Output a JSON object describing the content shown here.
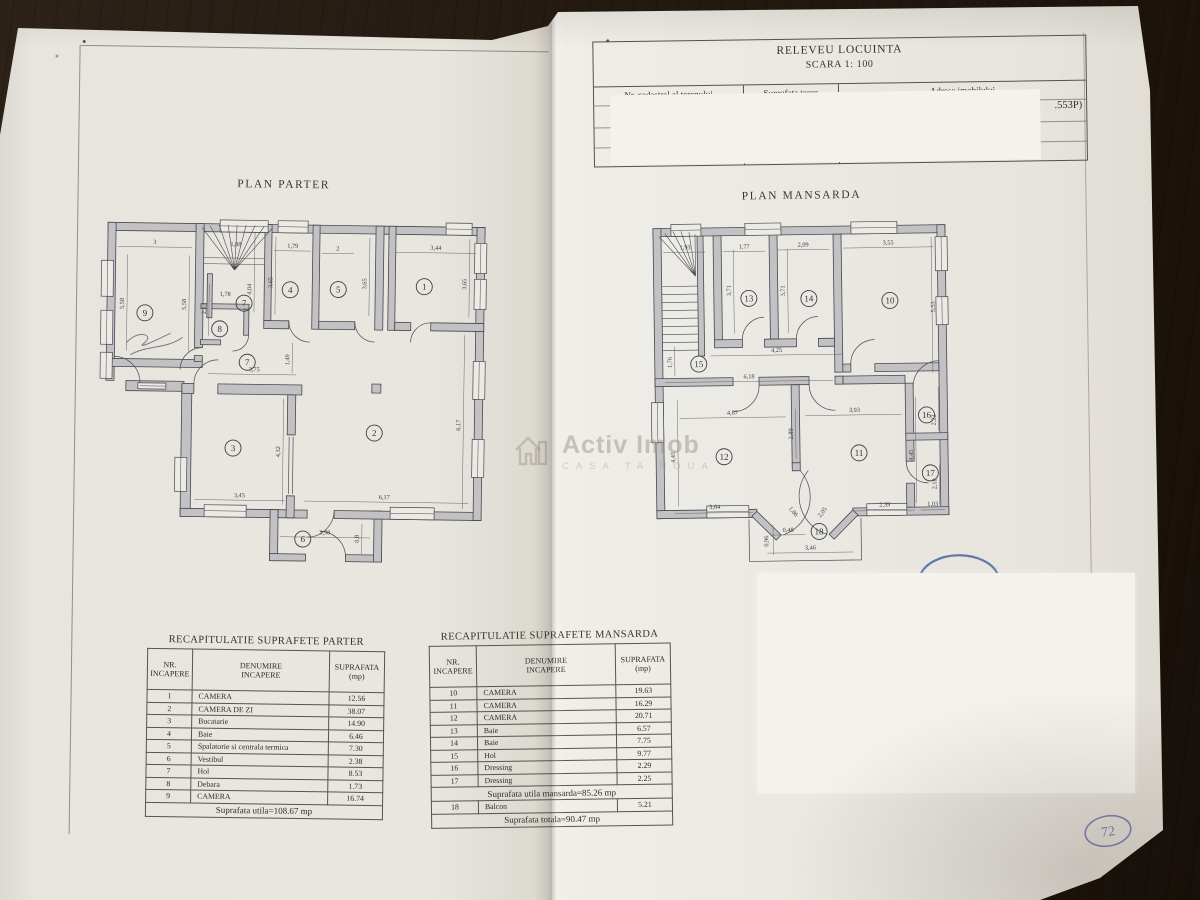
{
  "header": {
    "title": "RELEVEU LOCUINTA",
    "scale": "SCARA 1: 100",
    "columns": [
      "Nr. cadastral al terenului",
      "Suprafata teren",
      "Adresa imobilului"
    ],
    "fragment": ".553P)"
  },
  "watermark": {
    "brand": "Activ Imob",
    "tagline": "CASA TA NOUA"
  },
  "page_note": "72",
  "plans": [
    {
      "id": "parter",
      "title": "PLAN PARTER",
      "rooms": [
        {
          "n": "1",
          "x": 327,
          "y": 72
        },
        {
          "n": "2",
          "x": 279,
          "y": 219
        },
        {
          "n": "3",
          "x": 138,
          "y": 236
        },
        {
          "n": "4",
          "x": 193,
          "y": 77
        },
        {
          "n": "5",
          "x": 241,
          "y": 76
        },
        {
          "n": "6",
          "x": 209,
          "y": 326
        },
        {
          "n": "7",
          "x": 147,
          "y": 91
        },
        {
          "n": "7",
          "x": 151,
          "y": 150
        },
        {
          "n": "8",
          "x": 123,
          "y": 117
        },
        {
          "n": "9",
          "x": 48,
          "y": 102
        }
      ],
      "dims": [
        {
          "t": "3",
          "x": 57,
          "y": 33,
          "r": 0
        },
        {
          "t": "1,88",
          "x": 138,
          "y": 34,
          "r": 0
        },
        {
          "t": "1,79",
          "x": 195,
          "y": 35,
          "r": 0
        },
        {
          "t": "2",
          "x": 240,
          "y": 37,
          "r": 0
        },
        {
          "t": "3,44",
          "x": 338,
          "y": 35,
          "r": 0
        },
        {
          "t": "5,58",
          "x": 27,
          "y": 93,
          "r": -90
        },
        {
          "t": "5,58",
          "x": 89,
          "y": 93,
          "r": -90
        },
        {
          "t": "2,23",
          "x": 109,
          "y": 97,
          "r": -90
        },
        {
          "t": "1,78",
          "x": 128,
          "y": 84,
          "r": 0
        },
        {
          "t": "4,04",
          "x": 154,
          "y": 77,
          "r": -90
        },
        {
          "t": "3,65",
          "x": 175,
          "y": 70,
          "r": -90
        },
        {
          "t": "3,65",
          "x": 269,
          "y": 70,
          "r": -90
        },
        {
          "t": "3,65",
          "x": 369,
          "y": 69,
          "r": -90
        },
        {
          "t": "3,75",
          "x": 158,
          "y": 159,
          "r": 0
        },
        {
          "t": "1,49",
          "x": 193,
          "y": 147,
          "r": -90
        },
        {
          "t": "4,32",
          "x": 185,
          "y": 239,
          "r": -90
        },
        {
          "t": "3,45",
          "x": 145,
          "y": 285,
          "r": 0
        },
        {
          "t": "6,17",
          "x": 290,
          "y": 285,
          "r": 0
        },
        {
          "t": "6,17",
          "x": 365,
          "y": 210,
          "r": -90
        },
        {
          "t": "2,98",
          "x": 231,
          "y": 321,
          "r": 0
        },
        {
          "t": "0,8",
          "x": 265,
          "y": 325,
          "r": -90
        }
      ]
    },
    {
      "id": "mansarda",
      "title": "PLAN MANSARDA",
      "rooms": [
        {
          "n": "10",
          "x": 244,
          "y": 85
        },
        {
          "n": "11",
          "x": 211,
          "y": 237
        },
        {
          "n": "12",
          "x": 76,
          "y": 239
        },
        {
          "n": "13",
          "x": 103,
          "y": 81
        },
        {
          "n": "14",
          "x": 163,
          "y": 82
        },
        {
          "n": "15",
          "x": 52,
          "y": 146
        },
        {
          "n": "16",
          "x": 279,
          "y": 200
        },
        {
          "n": "17",
          "x": 282,
          "y": 258
        },
        {
          "n": "18",
          "x": 170,
          "y": 315
        }
      ],
      "dims": [
        {
          "t": "1,93",
          "x": 40,
          "y": 31,
          "r": 0
        },
        {
          "t": "1,77",
          "x": 99,
          "y": 31,
          "r": 0
        },
        {
          "t": "2,09",
          "x": 158,
          "y": 30,
          "r": 0
        },
        {
          "t": "3,55",
          "x": 243,
          "y": 29,
          "r": 0
        },
        {
          "t": "3,71",
          "x": 85,
          "y": 73,
          "r": -90
        },
        {
          "t": "3,71",
          "x": 139,
          "y": 74,
          "r": -90
        },
        {
          "t": "5,53",
          "x": 289,
          "y": 92,
          "r": -90
        },
        {
          "t": "4,25",
          "x": 130,
          "y": 135,
          "r": 0
        },
        {
          "t": "1,76",
          "x": 25,
          "y": 144,
          "r": -90
        },
        {
          "t": "6,18",
          "x": 102,
          "y": 161,
          "r": 0
        },
        {
          "t": "4,87",
          "x": 85,
          "y": 197,
          "r": 0
        },
        {
          "t": "3,93",
          "x": 207,
          "y": 196,
          "r": 0
        },
        {
          "t": "2,89",
          "x": 145,
          "y": 217,
          "r": -90
        },
        {
          "t": "4,45",
          "x": 27,
          "y": 239,
          "r": -90
        },
        {
          "t": "4,45",
          "x": 265,
          "y": 240,
          "r": -90
        },
        {
          "t": "2,22",
          "x": 288,
          "y": 205,
          "r": -90
        },
        {
          "t": "2,18",
          "x": 288,
          "y": 269,
          "r": -90
        },
        {
          "t": "3,64",
          "x": 66,
          "y": 291,
          "r": 0
        },
        {
          "t": "2,39",
          "x": 236,
          "y": 291,
          "r": 0
        },
        {
          "t": "1,03",
          "x": 284,
          "y": 291,
          "r": 0
        },
        {
          "t": "1,86",
          "x": 143,
          "y": 296,
          "r": 52
        },
        {
          "t": "2,05",
          "x": 175,
          "y": 297,
          "r": -52
        },
        {
          "t": "0,48",
          "x": 139,
          "y": 315,
          "r": 0
        },
        {
          "t": "0,96",
          "x": 119,
          "y": 324,
          "r": -90
        },
        {
          "t": "3,46",
          "x": 161,
          "y": 333,
          "r": 0
        }
      ]
    }
  ],
  "tables": [
    {
      "title": "RECAPITULATIE SUPRAFETE PARTER",
      "headers": {
        "nr": "NR.\nINCAPERE",
        "den": "DENUMIRE\nINCAPERE",
        "sup": "SUPRAFATA\n(mp)"
      },
      "rows": [
        [
          "1",
          "CAMERA",
          "12.56"
        ],
        [
          "2",
          "CAMERA DE ZI",
          "38.07"
        ],
        [
          "3",
          "Bucatarie",
          "14.90"
        ],
        [
          "4",
          "Baie",
          "6.46"
        ],
        [
          "5",
          "Spalatorie si centrala termica",
          "7.30"
        ],
        [
          "6",
          "Vestibul",
          "2.38"
        ],
        [
          "7",
          "Hol",
          "8.53"
        ],
        [
          "8",
          "Debara",
          "1.73"
        ],
        [
          "9",
          "CAMERA",
          "16.74"
        ]
      ],
      "total": "Suprafata utila=108.67 mp"
    },
    {
      "title": "RECAPITULATIE SUPRAFETE MANSARDA",
      "headers": {
        "nr": "NR.\nINCAPERE",
        "den": "DENUMIRE\nINCAPERE",
        "sup": "SUPRAFATA\n(mp)"
      },
      "rows": [
        [
          "10",
          "CAMERA",
          "19.63"
        ],
        [
          "11",
          "CAMERA",
          "16.29"
        ],
        [
          "12",
          "CAMERA",
          "20.71"
        ],
        [
          "13",
          "Baie",
          "6.57"
        ],
        [
          "14",
          "Baie",
          "7.75"
        ],
        [
          "15",
          "Hol",
          "9.77"
        ],
        [
          "16",
          "Dressing",
          "2.29"
        ],
        [
          "17",
          "Dressing",
          "2.25"
        ]
      ],
      "subtotal": "Suprafata utila mansarda=85.26 mp",
      "extra_row": [
        "18",
        "Balcon",
        "5.21"
      ],
      "total": "Suprafata totala=90.47 mp"
    }
  ]
}
